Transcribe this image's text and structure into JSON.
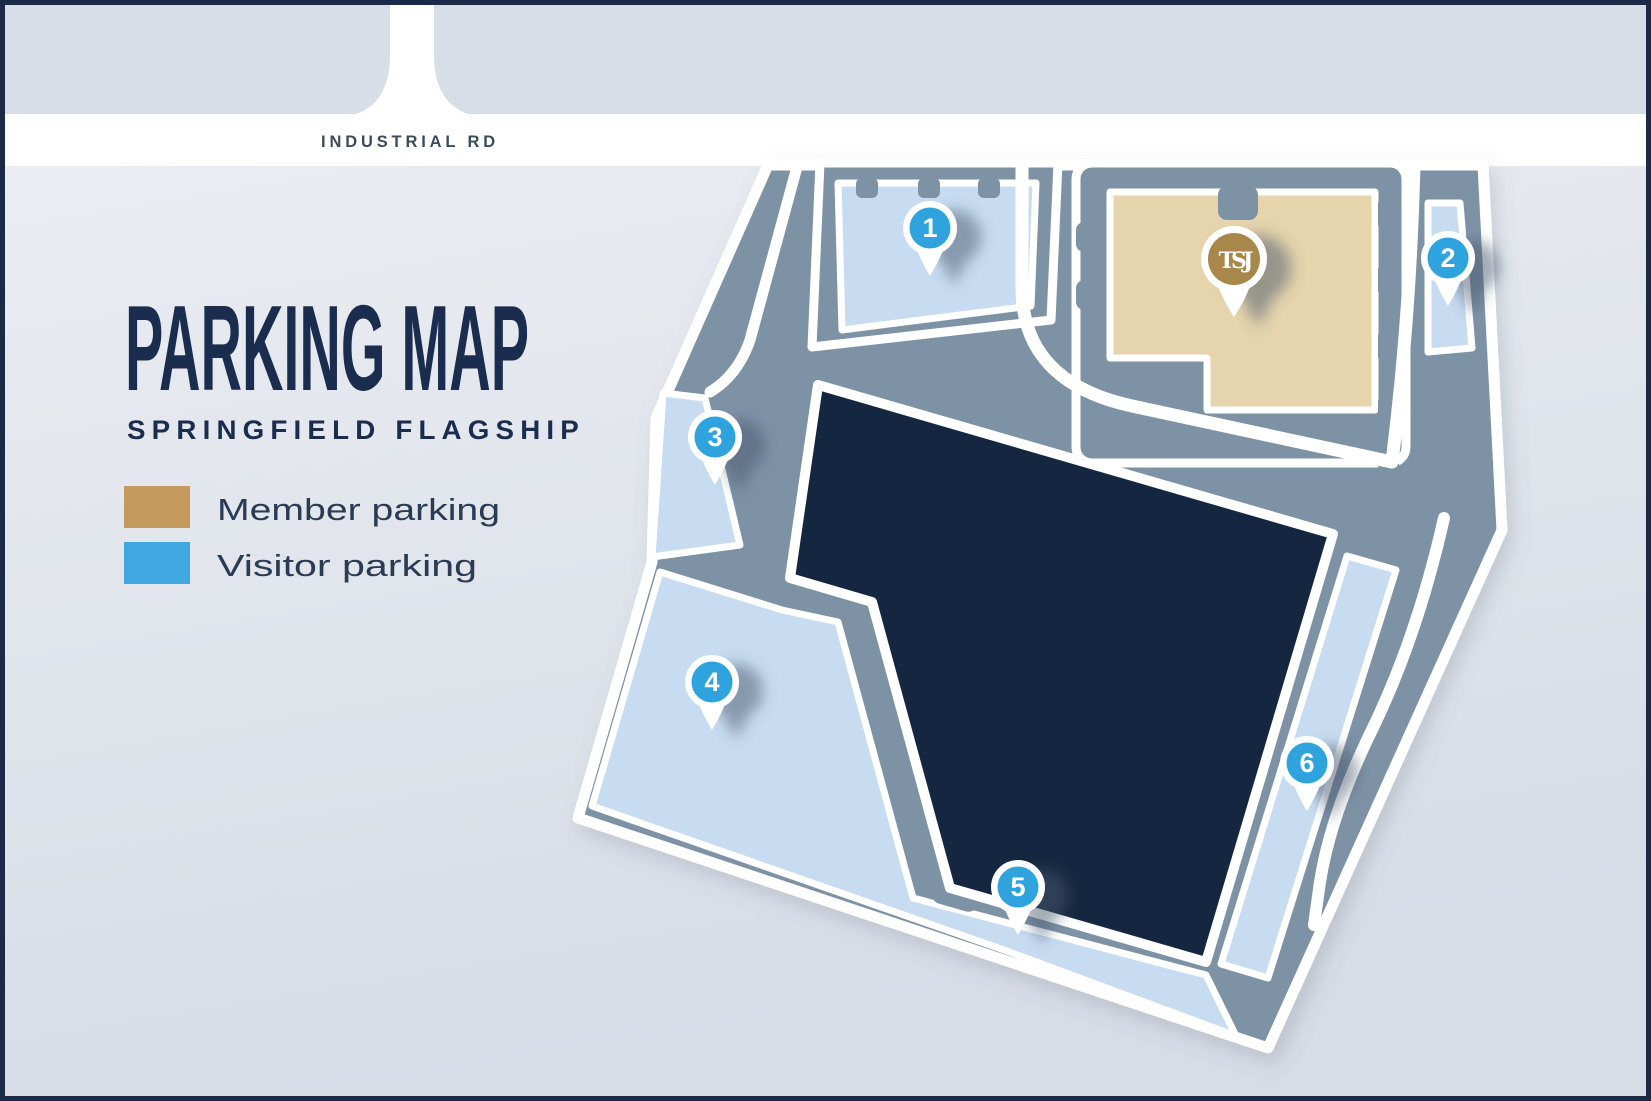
{
  "title": {
    "heading": "PARKING MAP",
    "subheading": "SPRINGFIELD FLAGSHIP"
  },
  "legend": {
    "items": [
      {
        "label": "Member parking",
        "color": "#C59A5F"
      },
      {
        "label": "Visitor parking",
        "color": "#3FA8E0"
      }
    ]
  },
  "road": {
    "name": "INDUSTRIAL RD"
  },
  "map": {
    "pins": [
      {
        "label": "1",
        "lot_type": "visitor"
      },
      {
        "label": "2",
        "lot_type": "visitor"
      },
      {
        "label": "3",
        "lot_type": "visitor"
      },
      {
        "label": "4",
        "lot_type": "visitor"
      },
      {
        "label": "5",
        "lot_type": "visitor"
      },
      {
        "label": "6",
        "lot_type": "visitor"
      }
    ],
    "logo_pin": {
      "monogram": "TSJ",
      "lot_type": "member"
    }
  },
  "colors": {
    "page_bg_top": "#EDF0F4",
    "page_bg_bottom": "#D7DCE5",
    "block_gray": "#D8DEE8",
    "road_white": "#FFFFFF",
    "site_gray": "#7E92A6",
    "building_navy": "#152740",
    "lot_blue": "#C7DCF1",
    "lot_tan": "#E5D4AC",
    "pin_blue": "#2EA3DE",
    "pin_gold": "#A8874B",
    "title_navy": "#1B2D4F",
    "road_label_gray": "#3D4A59",
    "legend_text": "#2A3B54",
    "frame_navy": "#1B2B47"
  }
}
